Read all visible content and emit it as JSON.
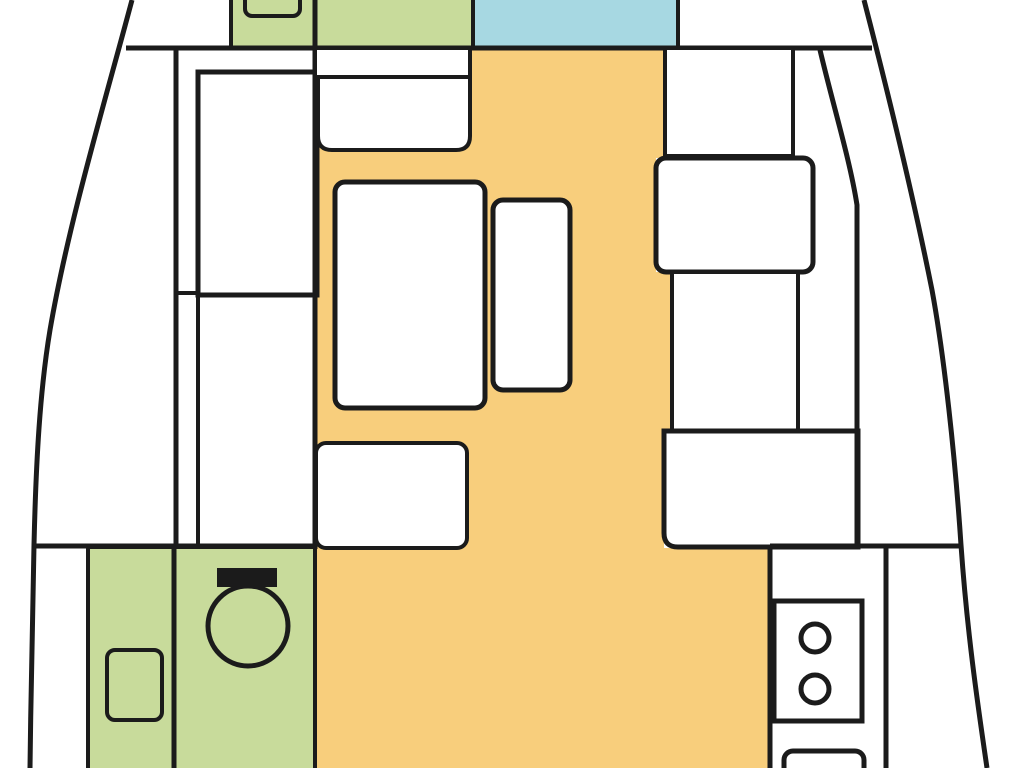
{
  "diagram": {
    "kind": "sailboat-interior-floor-plan",
    "canvas": {
      "width": 1024,
      "height": 768
    },
    "colors": {
      "outline": "#1b1b1b",
      "floor": "#F8CE7C",
      "head": "#C8DB9B",
      "shower": "#A7D8E2",
      "furniture": "#FFFFFF",
      "background": "#FFFFFF"
    },
    "shapes": [
      {
        "name": "salon-floor",
        "type": "path",
        "d": "M 313,50 H 663 V 158 H 656 V 272 H 672 V 431 H 664 V 548 H 770 V 768 H 313 Z",
        "fill": "floor"
      },
      {
        "name": "fwd-head-compartment",
        "type": "rect",
        "x": 231,
        "y": -6,
        "w": 87,
        "h": 54,
        "fill": "head",
        "stroke": "outline",
        "sw": 4
      },
      {
        "name": "fwd-head-room",
        "type": "rect",
        "x": 315,
        "y": -6,
        "w": 158,
        "h": 54,
        "fill": "head",
        "stroke": "outline",
        "sw": 4
      },
      {
        "name": "fwd-shower-room",
        "type": "rect",
        "x": 473,
        "y": -6,
        "w": 205,
        "h": 54,
        "fill": "shower",
        "stroke": "outline",
        "sw": 4
      },
      {
        "name": "fwd-head-sink",
        "type": "rect",
        "x": 245,
        "y": -14,
        "w": 55,
        "h": 30,
        "rx": 7,
        "fill": "head",
        "stroke": "outline",
        "sw": 4
      },
      {
        "name": "main-bulkhead-wall",
        "type": "line",
        "x1": 126,
        "y1": 48,
        "x2": 872,
        "y2": 48,
        "stroke": "outline",
        "sw": 5
      },
      {
        "name": "port-cabin-wall",
        "type": "line",
        "x1": 176,
        "y1": 48,
        "x2": 176,
        "y2": 546,
        "stroke": "outline",
        "sw": 5
      },
      {
        "name": "port-cabin-inner-wall",
        "type": "line",
        "x1": 198,
        "y1": 293,
        "x2": 198,
        "y2": 546,
        "stroke": "outline",
        "sw": 4
      },
      {
        "name": "port-berth",
        "type": "rect",
        "x": 198,
        "y": 72,
        "w": 119,
        "h": 223,
        "fill": "furniture",
        "stroke": "outline",
        "sw": 5
      },
      {
        "name": "port-berth-foot-line",
        "type": "line",
        "x1": 176,
        "y1": 293,
        "x2": 200,
        "y2": 293,
        "stroke": "outline",
        "sw": 4
      },
      {
        "name": "center-wall",
        "type": "line",
        "x1": 315,
        "y1": -6,
        "x2": 315,
        "y2": 549,
        "stroke": "outline",
        "sw": 5
      },
      {
        "name": "salon-strip",
        "type": "rect",
        "x": 317,
        "y": 50,
        "w": 153,
        "h": 27,
        "fill": "furniture"
      },
      {
        "name": "salon-strip-divider",
        "type": "line",
        "x1": 470,
        "y1": 48,
        "x2": 470,
        "y2": 79,
        "stroke": "outline",
        "sw": 4
      },
      {
        "name": "salon-seat-fwd",
        "type": "path",
        "d": "M 318,77 H 470 V 136 Q 470,150 456,150 H 332 Q 318,150 318,136 Z",
        "fill": "furniture",
        "stroke": "outline",
        "sw": 4
      },
      {
        "name": "salon-table",
        "type": "rect",
        "x": 335,
        "y": 182,
        "w": 150,
        "h": 226,
        "rx": 10,
        "fill": "furniture",
        "stroke": "outline",
        "sw": 5
      },
      {
        "name": "salon-bench",
        "type": "rect",
        "x": 493,
        "y": 200,
        "w": 77,
        "h": 190,
        "rx": 10,
        "fill": "furniture",
        "stroke": "outline",
        "sw": 5
      },
      {
        "name": "salon-seat-aft",
        "type": "rect",
        "x": 316,
        "y": 443,
        "w": 151,
        "h": 105,
        "rx": 10,
        "fill": "furniture",
        "stroke": "outline",
        "sw": 4
      },
      {
        "name": "stbd-cabinet-fwd",
        "type": "rect",
        "x": 665,
        "y": 48,
        "w": 128,
        "h": 108,
        "fill": "furniture",
        "stroke": "outline",
        "sw": 4
      },
      {
        "name": "stbd-seat",
        "type": "rect",
        "x": 656,
        "y": 158,
        "w": 157,
        "h": 114,
        "rx": 10,
        "fill": "furniture",
        "stroke": "outline",
        "sw": 5
      },
      {
        "name": "stbd-cabinet-mid",
        "type": "rect",
        "x": 672,
        "y": 272,
        "w": 126,
        "h": 159,
        "fill": "furniture",
        "stroke": "outline",
        "sw": 4
      },
      {
        "name": "stbd-chart-table",
        "type": "path",
        "d": "M 664,431 H 858 V 547 H 678 Q 664,547 664,533 Z",
        "fill": "furniture",
        "stroke": "outline",
        "sw": 5
      },
      {
        "name": "stbd-inner-wall",
        "type": "path",
        "d": "M 820,50 C 833,105 850,160 857,205 L 857,547",
        "fill": "none",
        "stroke": "outline",
        "sw": 5
      },
      {
        "name": "aft-bulkhead-port",
        "type": "line",
        "x1": 34,
        "y1": 546,
        "x2": 315,
        "y2": 546,
        "stroke": "outline",
        "sw": 5
      },
      {
        "name": "aft-bulkhead-stbd",
        "type": "line",
        "x1": 770,
        "y1": 546,
        "x2": 959,
        "y2": 546,
        "stroke": "outline",
        "sw": 5
      },
      {
        "name": "aft-head-room",
        "type": "rect",
        "x": 88,
        "y": 547,
        "w": 227,
        "h": 228,
        "fill": "head",
        "stroke": "outline",
        "sw": 4
      },
      {
        "name": "aft-head-divider",
        "type": "line",
        "x1": 174,
        "y1": 547,
        "x2": 174,
        "y2": 768,
        "stroke": "outline",
        "sw": 5
      },
      {
        "name": "aft-head-sink",
        "type": "rect",
        "x": 107,
        "y": 650,
        "w": 55,
        "h": 70,
        "rx": 8,
        "fill": "head",
        "stroke": "outline",
        "sw": 4
      },
      {
        "name": "toilet-bowl",
        "type": "circle",
        "cx": 248,
        "cy": 626,
        "r": 40,
        "fill": "head",
        "stroke": "outline",
        "sw": 5
      },
      {
        "name": "toilet-tank",
        "type": "rect",
        "x": 217,
        "y": 568,
        "w": 60,
        "h": 19,
        "fill": "outline"
      },
      {
        "name": "galley-wall-inner",
        "type": "line",
        "x1": 770,
        "y1": 546,
        "x2": 770,
        "y2": 768,
        "stroke": "outline",
        "sw": 5
      },
      {
        "name": "galley-wall-outer",
        "type": "line",
        "x1": 886,
        "y1": 546,
        "x2": 886,
        "y2": 768,
        "stroke": "outline",
        "sw": 5
      },
      {
        "name": "galley-stove",
        "type": "rect",
        "x": 774,
        "y": 601,
        "w": 88,
        "h": 120,
        "fill": "furniture",
        "stroke": "outline",
        "sw": 5
      },
      {
        "name": "stove-burner-fwd",
        "type": "circle",
        "cx": 815,
        "cy": 638,
        "r": 14,
        "fill": "furniture",
        "stroke": "outline",
        "sw": 5
      },
      {
        "name": "stove-burner-aft",
        "type": "circle",
        "cx": 815,
        "cy": 689,
        "r": 14,
        "fill": "furniture",
        "stroke": "outline",
        "sw": 5
      },
      {
        "name": "galley-sink",
        "type": "rect",
        "x": 784,
        "y": 751,
        "w": 80,
        "h": 50,
        "rx": 9,
        "fill": "furniture",
        "stroke": "outline",
        "sw": 5
      },
      {
        "name": "hull-port",
        "type": "path",
        "d": "M 132,0 C 104,105 68,225 50,330 C 40,390 36,460 34,545 C 32,625 31,695 30,768",
        "fill": "none",
        "stroke": "outline",
        "sw": 5
      },
      {
        "name": "hull-stbd",
        "type": "path",
        "d": "M 864,0 C 886,85 912,190 932,290 C 944,355 955,455 961,545 C 967,630 977,700 987,768",
        "fill": "none",
        "stroke": "outline",
        "sw": 5
      }
    ]
  }
}
